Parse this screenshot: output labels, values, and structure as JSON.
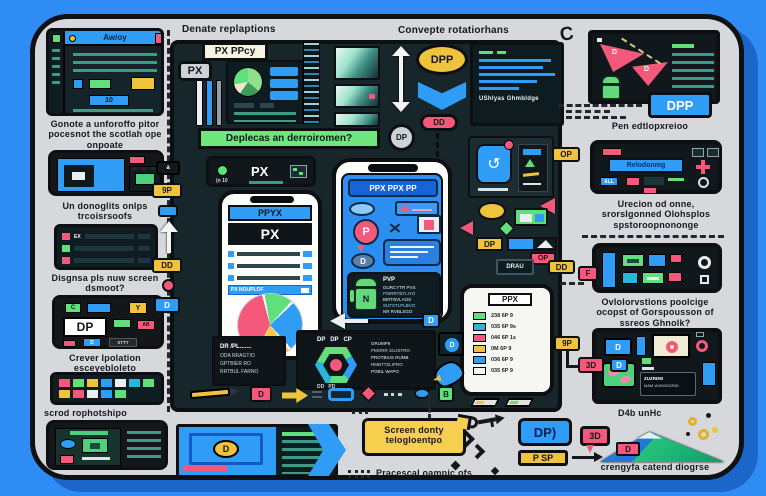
{
  "headers": {
    "left": "Denate replaptions",
    "right": "Convepte rotatiorhans",
    "corner_glyph": "C"
  },
  "left_col": {
    "browser_title": "Aw/oy",
    "browser_num": "10",
    "caption1": "Gonote a unforoffo pitor pocesnot the scotlah ope onpoate",
    "caption2": "Un donoglits onlps trcoisrsoofs",
    "caption3": "Disgnsa pls nuw screen dsmoot?",
    "caption4": "Crever Ipolation esceyebloleto",
    "caption5": "scrod rophotshipo",
    "row_tag": "EX",
    "dp_device": {
      "chip1": "C",
      "chip2": "Y",
      "label": "DP",
      "chip3": "AB",
      "chip4": "D",
      "chip5": "STTT"
    }
  },
  "edge": {
    "badge_a": "a",
    "badge_9p": "9P",
    "badge_dd": "DD",
    "badge_d": "D",
    "badge_op": "OP",
    "badge_dd2": "DD",
    "badge_f": "F",
    "badge_9p2": "9P",
    "badge_3d": "3D",
    "badge_d2": "D"
  },
  "panel": {
    "px_ppcy": "PX PPcy",
    "px_badge": "PX",
    "banner": "Deplecas an derroiromen?",
    "dp_circle": "DP",
    "dpp": "DPP",
    "dd_pill": "DD",
    "code_caption": "UShlyas Ghmbldge",
    "toolbar_note": "(n 10",
    "toolbar_px": "PX",
    "dp_tag": "DP",
    "op_tag": "OP",
    "drau": "DRAU",
    "icon_d": "D",
    "icon_b": "B"
  },
  "phone_px": {
    "header": "PPYX",
    "banner": "PX",
    "row_hl": "PX NOUPLOF"
  },
  "phone_chat": {
    "header": "PPX PPX PP",
    "bubble_p": "P",
    "bubble_d": "D",
    "android": "N",
    "code_title": "PVP",
    "line1": "GURCYTR PVS",
    "line2": "PSIRRTBTLIYO",
    "line3": "BIRTBVLAOS",
    "line4": "SUTSTLPLBVO",
    "line5": "NR RVBLSGO"
  },
  "phone_list": {
    "header": "PPX",
    "rows": [
      {
        "color": "#5fe07d",
        "text": "238 6P 9"
      },
      {
        "color": "#29b6d8",
        "text": "035 6P 9s"
      },
      {
        "color": "#f4587a",
        "text": "046 6P 1s"
      },
      {
        "color": "#f0c33c",
        "text": "0M 6P 9"
      },
      {
        "color": "#2f9df5",
        "text": "036 6P 9"
      },
      {
        "color": "#f6f6f3",
        "text": "035 6P 9"
      }
    ]
  },
  "code_panel": {
    "title": "DR /PL.......",
    "line1": "ODA RRAGTIO",
    "line2": "GPTBIER RO",
    "line3": "RRTBUL FARNO"
  },
  "hex_panel": {
    "top_labels": "DP   DP   CP",
    "bottom_labels": "DD   PD",
    "side_d": "D",
    "line1": "GRUMP9",
    "line2": "PMORR SUJSTRO",
    "line3": "PROTBIUS RUMB",
    "line4": "RMBTTZLIPRO",
    "line5": "POBIL WAPO"
  },
  "bottom": {
    "video_d": "D",
    "bubble": "Screen donty telogloentpo",
    "caption": "Pracescal oampic ofs",
    "dp_btn": "DP)",
    "psp_btn": "P SP",
    "threed": "3D",
    "mountain_chip": "D",
    "units": "D4b unHc",
    "caption2": "crengyfa catend diogrse"
  },
  "right_col": {
    "tri_d1": "D",
    "tri_d2": "D",
    "dpp_btn": "DPP",
    "caption1": "Pen edtlopxreioo",
    "reload": "Relodonmg",
    "all_chip": "ALL",
    "caption2": "Urecion od onne, srorslgonned Olohsplos spstoroopnononge",
    "caption3": "Ovlolorvstions poolcige ocopst of Gorspousson of ssreos Ghnolk?",
    "tablet_line1": "ZUZRDM",
    "tablet_line2": "MAM WJMXDDRID",
    "tile_d": "D"
  }
}
